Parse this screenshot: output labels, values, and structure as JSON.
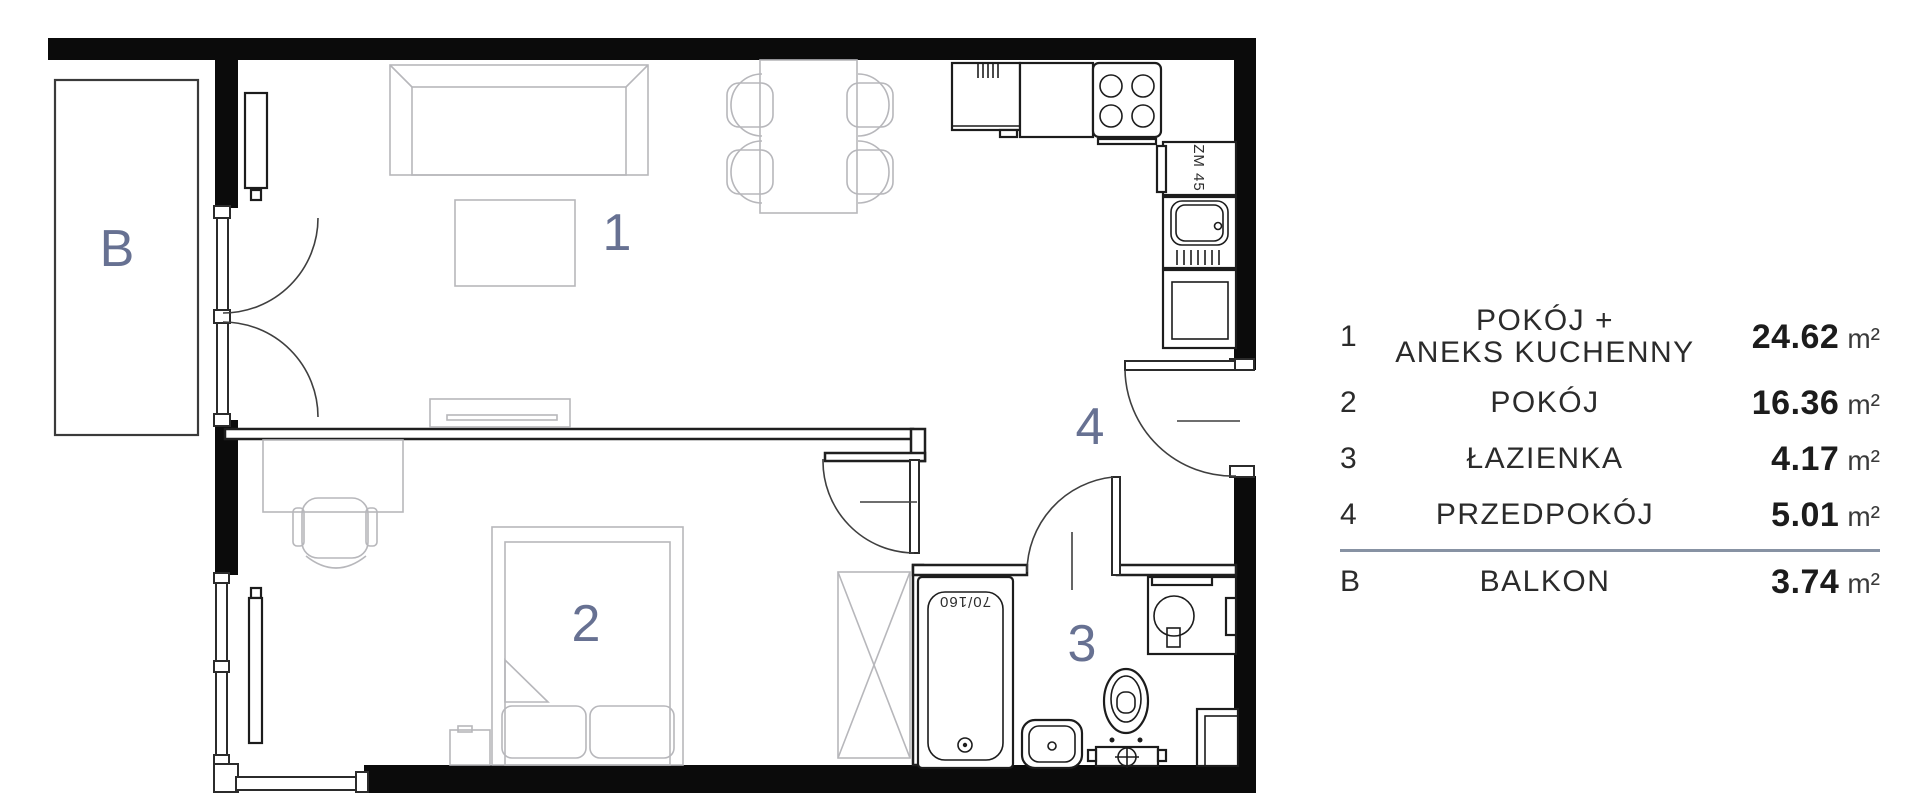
{
  "plan": {
    "labels": {
      "room1": "1",
      "room2": "2",
      "room3": "3",
      "room4": "4",
      "balcony": "B"
    },
    "annotations": {
      "bathtub_size": "70/160",
      "dishwasher_label": "ZM 45"
    },
    "colors": {
      "room_label": "#677192",
      "wall": "#0b0b0b",
      "furniture": "#b7b7bb"
    }
  },
  "legend": {
    "divider_color": "#8792a3",
    "rows": [
      {
        "num": "1",
        "name_line1": "POKÓJ +",
        "name_line2": "ANEKS KUCHENNY",
        "area": "24.62",
        "unit": "m²"
      },
      {
        "num": "2",
        "name_line1": "POKÓJ",
        "name_line2": "",
        "area": "16.36",
        "unit": "m²"
      },
      {
        "num": "3",
        "name_line1": "ŁAZIENKA",
        "name_line2": "",
        "area": "4.17",
        "unit": "m²"
      },
      {
        "num": "4",
        "name_line1": "PRZEDPOKÓJ",
        "name_line2": "",
        "area": "5.01",
        "unit": "m²"
      },
      {
        "num": "B",
        "name_line1": "BALKON",
        "name_line2": "",
        "area": "3.74",
        "unit": "m²"
      }
    ]
  }
}
